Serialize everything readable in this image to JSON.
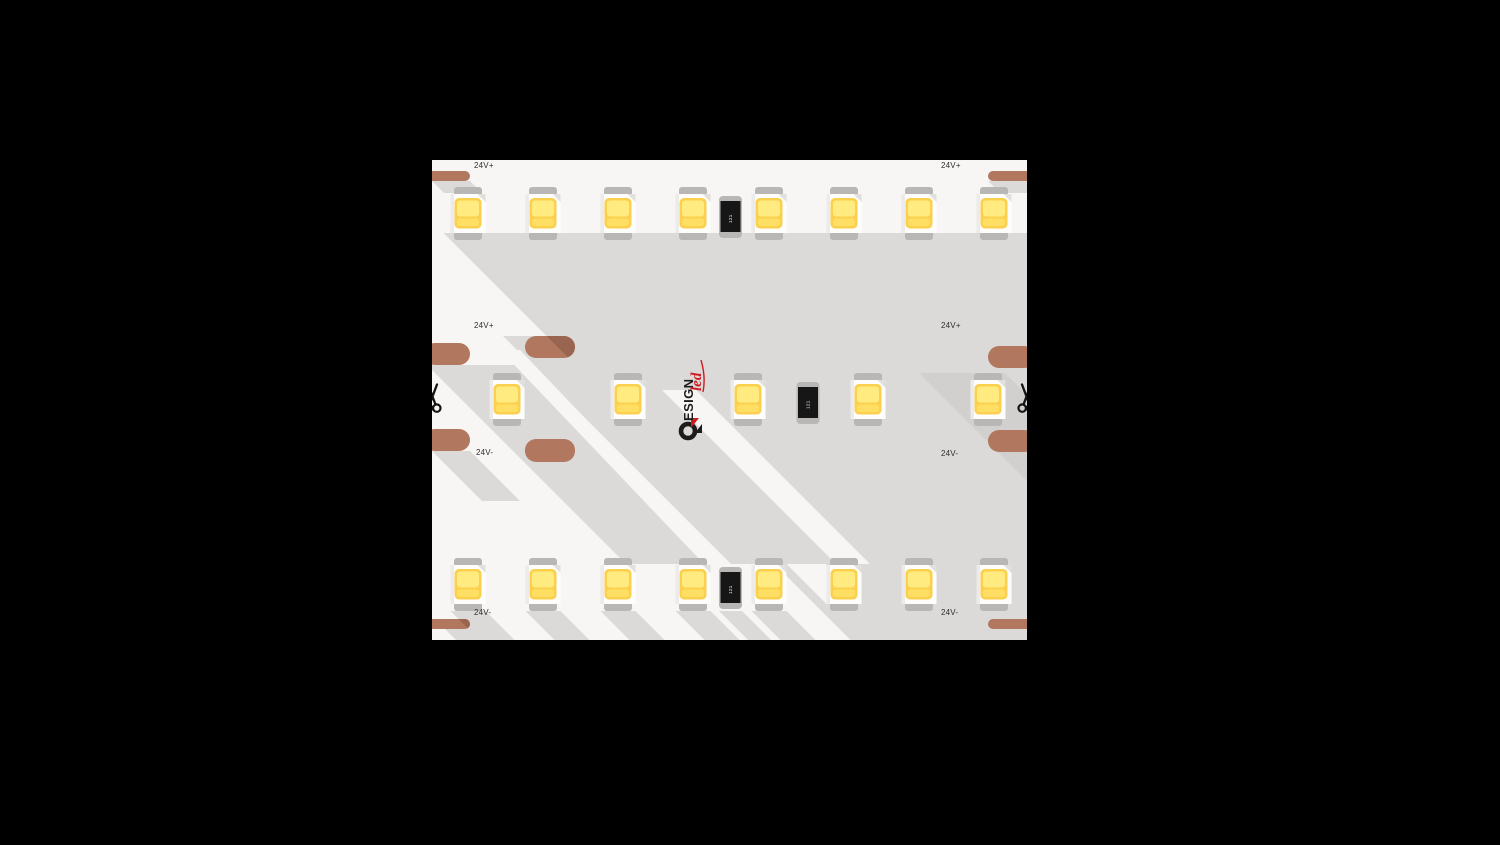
{
  "background_color": "#000000",
  "strip": {
    "labels": {
      "positive": "24V+",
      "negative": "24V-"
    },
    "resistor_code": "121",
    "logo": {
      "letters_after_glyph": "ESIGN",
      "script": "led"
    },
    "rows": {
      "top_led_count": 8,
      "middle_led_count": 5,
      "bottom_led_count": 8,
      "resistors_count": 3
    },
    "icons": {
      "cut_mark": "scissors-icon",
      "logo_mark": "design-led-d-glyph"
    },
    "colors": {
      "background": "#000000",
      "strip_base": "#f8f6f4",
      "shadow": "#dcdad8",
      "shadow_dark": "#d2d0ce",
      "copper": "#b1785f",
      "copper_shadow": "#9a6550",
      "led_tab": "#b9b7b5",
      "led_body": "#fdfdfc",
      "led_yellow": "#fbd04e",
      "led_yellow_light": "#ffeb80",
      "led_yellow_mid": "#ffdf63",
      "resistor_body": "#161616",
      "resistor_text": "#ffffff",
      "logo_black": "#1d1c1b",
      "logo_red": "#cf1a20",
      "label_text": "#2e2d2b",
      "scissors": "#141414"
    }
  }
}
